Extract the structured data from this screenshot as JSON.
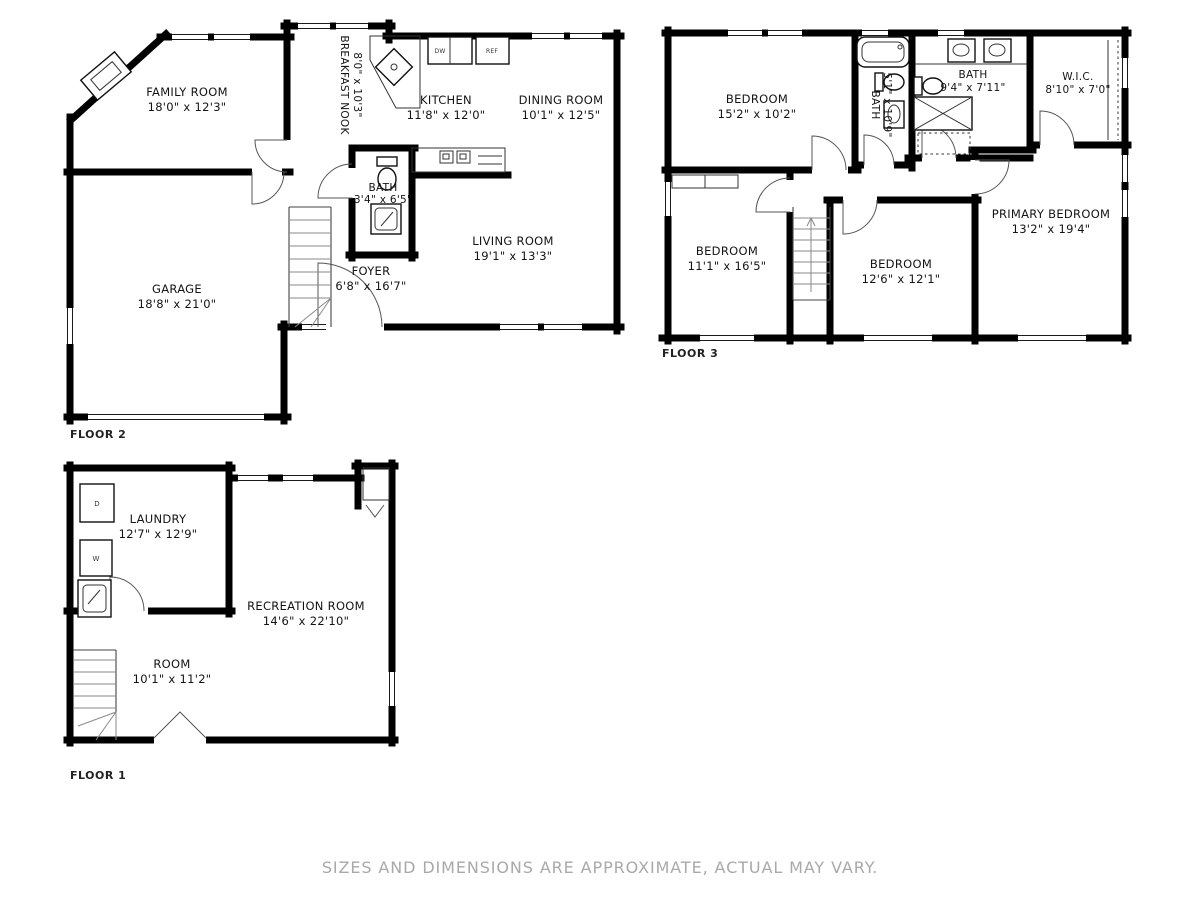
{
  "disclaimer": "SIZES AND DIMENSIONS ARE APPROXIMATE, ACTUAL MAY VARY.",
  "colors": {
    "wall": "#000000",
    "background": "#ffffff",
    "disclaimer_text": "#a9a9a9"
  },
  "floor2": {
    "label": "FLOOR 2",
    "rooms": {
      "family_room": {
        "name": "FAMILY ROOM",
        "dims": "18'0\" x 12'3\""
      },
      "breakfast_nook": {
        "name": "BREAKFAST NOOK",
        "dims": "8'0\" x 10'3\""
      },
      "kitchen": {
        "name": "KITCHEN",
        "dims": "11'8\" x 12'0\""
      },
      "dining_room": {
        "name": "DINING ROOM",
        "dims": "10'1\" x 12'5\""
      },
      "bath": {
        "name": "BATH",
        "dims": "3'4\" x 6'5\""
      },
      "living_room": {
        "name": "LIVING ROOM",
        "dims": "19'1\" x 13'3\""
      },
      "foyer": {
        "name": "FOYER",
        "dims": "6'8\" x 16'7\""
      },
      "garage": {
        "name": "GARAGE",
        "dims": "18'8\" x 21'0\""
      }
    },
    "appliances": {
      "dishwasher": "DW",
      "refrigerator": "REF"
    }
  },
  "floor3": {
    "label": "FLOOR 3",
    "rooms": {
      "bedroom1": {
        "name": "BEDROOM",
        "dims": "15'2\" x 10'2\""
      },
      "bath_small": {
        "name": "BATH",
        "dims": "5'1\" x 10'9\""
      },
      "bath_large": {
        "name": "BATH",
        "dims": "9'4\" x 7'11\""
      },
      "wic": {
        "name": "W.I.C.",
        "dims": "8'10\" x 7'0\""
      },
      "bedroom2": {
        "name": "BEDROOM",
        "dims": "11'1\" x 16'5\""
      },
      "bedroom3": {
        "name": "BEDROOM",
        "dims": "12'6\" x 12'1\""
      },
      "primary_bedroom": {
        "name": "PRIMARY BEDROOM",
        "dims": "13'2\" x 19'4\""
      }
    }
  },
  "floor1": {
    "label": "FLOOR 1",
    "rooms": {
      "laundry": {
        "name": "LAUNDRY",
        "dims": "12'7\" x 12'9\""
      },
      "recreation_room": {
        "name": "RECREATION ROOM",
        "dims": "14'6\" x 22'10\""
      },
      "room": {
        "name": "ROOM",
        "dims": "10'1\" x 11'2\""
      }
    },
    "appliances": {
      "dryer": "D",
      "washer": "W"
    }
  }
}
